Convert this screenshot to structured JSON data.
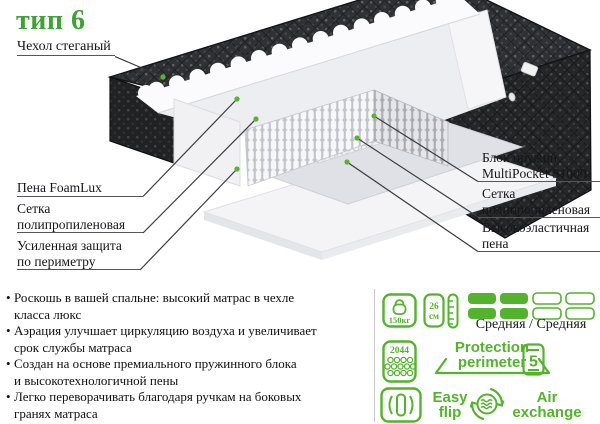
{
  "title": "тип 6",
  "colors": {
    "accent_green": "#3ea234",
    "icon_green": "#54b32c",
    "quilt_dark": "#2f3134",
    "dot_green": "#59b32c"
  },
  "diagram_labels": {
    "cover": "Чехол стеганый",
    "foam": "Пена FoamLux",
    "mesh_left": "Сетка\nполипропиленовая",
    "perimeter": "Усиленная защита\nпо периметру",
    "springs": "Блок пружин\nMultiPocket S1000",
    "mesh_right": "Сетка\nполипропиленовая",
    "elastic": "Высокоэластичная\nпена"
  },
  "bullets": {
    "marker": "•",
    "items": [
      "Роскошь в вашей спальне: высокий матрас в чехле\nкласса люкс",
      "Аэрация улучшает циркуляцию воздуха и увеличивает\nсрок службы матраса",
      "Создан на основе премиального пружинного блока\nи высокотехнологичной пены",
      "Легко переворачивать благодаря ручкам на боковых\nгранях матраса"
    ]
  },
  "features": {
    "max_weight": "150кг",
    "height_value": "26",
    "height_unit": "см",
    "firmness": "Средняя / Средняя",
    "springs_count": "2044",
    "protection_line1": "Protection",
    "protection_line2": "perimeter",
    "zones": "5",
    "flip_line1": "Easy",
    "flip_line2": "flip",
    "air_line1": "Air",
    "air_line2": "exchange"
  }
}
